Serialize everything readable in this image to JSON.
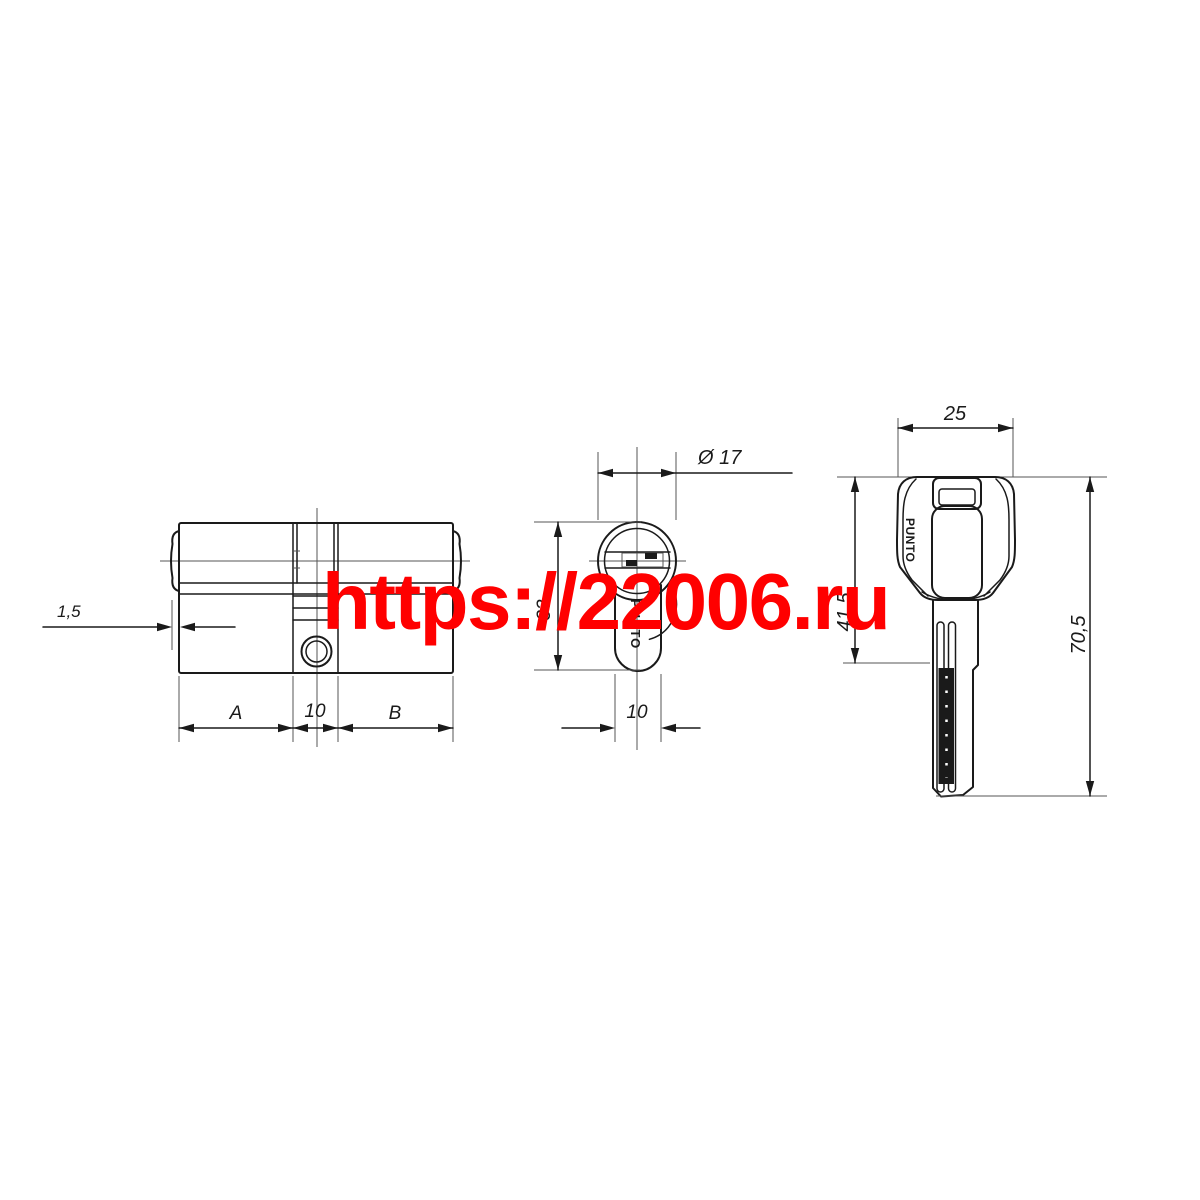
{
  "watermark": {
    "text": "https://22006.ru",
    "color": "#FF0000"
  },
  "drawing": {
    "brand": "PUNTO",
    "views": {
      "side": {
        "title": "cylinder-body-side-view",
        "dims": {
          "lip": "1,5",
          "a": "A",
          "center": "10",
          "b": "B"
        }
      },
      "end": {
        "title": "cylinder-end-view",
        "dims": {
          "diameter": "Ø 17",
          "height": "33",
          "width": "10"
        }
      },
      "key": {
        "title": "key-front-view",
        "dims": {
          "head_width": "25",
          "head_height": "41,5",
          "total_length": "70,5"
        }
      }
    }
  }
}
